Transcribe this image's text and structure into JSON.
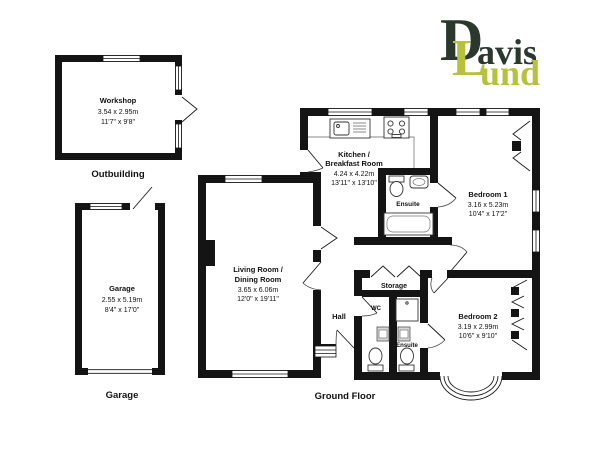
{
  "logo": {
    "brand_top_initial": "D",
    "brand_top_rest": "avis",
    "brand_bottom_initial": "L",
    "brand_bottom_rest": "und"
  },
  "colors": {
    "wall": "#141414",
    "logo_dark": "#2b382e",
    "logo_green": "#b6c23b",
    "background": "#ffffff"
  },
  "sections": {
    "outbuilding": "Outbuilding",
    "garage": "Garage",
    "ground_floor": "Ground Floor"
  },
  "rooms": {
    "workshop": {
      "name": "Workshop",
      "metric": "3.54 x 2.95m",
      "imperial": "11'7\" x 9'8\""
    },
    "garage": {
      "name": "Garage",
      "metric": "2.55 x 5.19m",
      "imperial": "8'4\" x 17'0\""
    },
    "kitchen": {
      "name_line1": "Kitchen /",
      "name_line2": "Breakfast Room",
      "metric": "4.24 x 4.22m",
      "imperial": "13'11\" x 13'10\""
    },
    "living": {
      "name_line1": "Living Room /",
      "name_line2": "Dining Room",
      "metric": "3.65 x 6.06m",
      "imperial": "12'0\" x 19'11\""
    },
    "bedroom1": {
      "name": "Bedroom 1",
      "metric": "3.16 x 5.23m",
      "imperial": "10'4\" x 17'2\""
    },
    "bedroom2": {
      "name": "Bedroom 2",
      "metric": "3.19 x 2.99m",
      "imperial": "10'6\" x 9'10\""
    },
    "ensuite1": {
      "name": "Ensuite"
    },
    "ensuite2": {
      "name": "Ensuite"
    },
    "wc": {
      "name": "WC"
    },
    "storage": {
      "name": "Storage"
    },
    "hall": {
      "name": "Hall"
    }
  }
}
